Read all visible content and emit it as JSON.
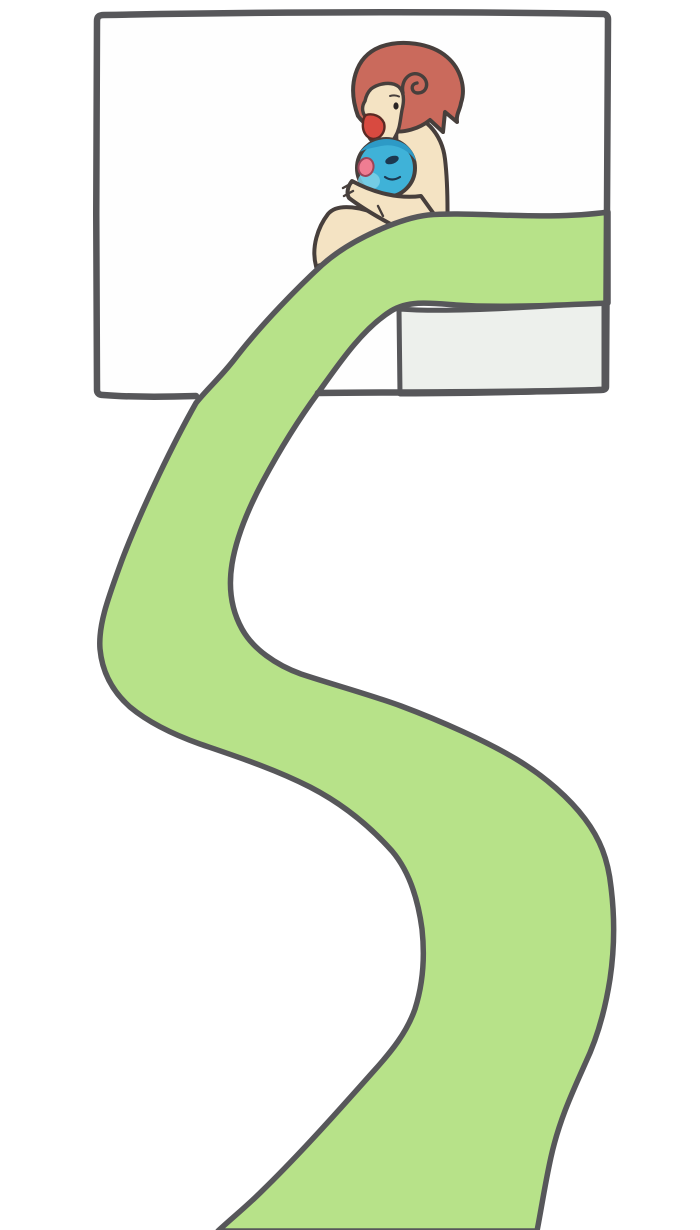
{
  "illustration": {
    "kind": "hand-drawn cartoon comic panel with winding slide",
    "palette": {
      "background": "#ffffff",
      "panel_fill": "#fefefe",
      "outline_dark": "#57575a",
      "character_outline": "#473f3c",
      "slide_green": "#b7e289",
      "wall_gray": "#edf0ec",
      "hair_red": "#ca6a5c",
      "skin_cream": "#f4e3c3",
      "creature_blue": "#3fb2d8",
      "creature_blue_dark": "#2d9ac6",
      "creature_blue_light": "#7ed0e6",
      "creature_eye_navy": "#1c3850",
      "creature_mouth_pink": "#ef7d92",
      "creature_mouth_edge": "#9c4458",
      "mouth_red": "#d84a40",
      "mouth_edge": "#5a2a24",
      "eye_black": "#2a2423"
    }
  }
}
